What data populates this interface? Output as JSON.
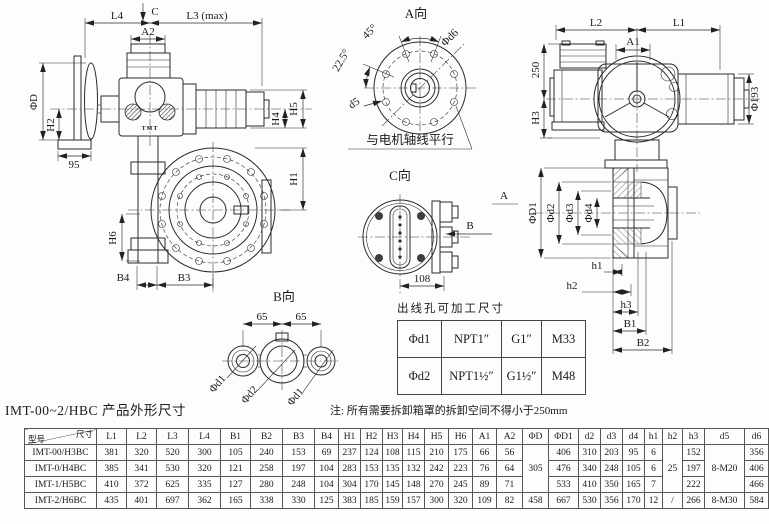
{
  "title": "IMT-00~2/HBC 产品外形尺寸",
  "note": "注: 所有需要拆卸箱罩的拆卸空间不得小于250mm",
  "colors": {
    "line": "#2b2b2b",
    "bg": "#fdfdfc"
  },
  "side_view": {
    "l4": "L4",
    "c": "C",
    "l3": "L3 (max)",
    "a2": "A2",
    "phid": "ΦD",
    "h2": "H2",
    "n95": "95",
    "h5": "H5",
    "h4": "H4",
    "h1": "H1",
    "h6": "H6",
    "b4": "B4",
    "b3": "B3",
    "logo": "TMT"
  },
  "view_a": {
    "label": "A向",
    "a45": "45°",
    "a225": "22.5°",
    "phid6": "Φd6",
    "d5": "d5",
    "note": "与电机轴线平行"
  },
  "front_view": {
    "l2": "L2",
    "l1": "L1",
    "a1": "A1",
    "n250": "250",
    "h3": "H3",
    "phi193": "Φ193"
  },
  "view_c": {
    "label": "C向",
    "n108": "108",
    "arrow_a": "A",
    "arrow_b": "B"
  },
  "section_view": {
    "phid1": "ΦD1",
    "phid2": "Φd2",
    "phid3": "Φd3",
    "phid4": "Φd4",
    "h1": "h1",
    "h2": "h2",
    "h3": "h3",
    "b1": "B1",
    "b2": "B2"
  },
  "view_b": {
    "label": "B向",
    "n65a": "65",
    "n65b": "65",
    "phid1a": "Φd1",
    "phid2": "Φd2",
    "phid1b": "Φd1"
  },
  "outlet_table": {
    "title": "出线孔可加工尺寸",
    "rows": [
      [
        "Φd1",
        "NPT1″",
        "G1″",
        "M33"
      ],
      [
        "Φd2",
        "NPT1½″",
        "G1½″",
        "M48"
      ]
    ]
  },
  "dim_table": {
    "corner_top": "尺寸",
    "corner_bottom": "型号",
    "columns": [
      "L1",
      "L2",
      "L3",
      "L4",
      "B1",
      "B2",
      "B3",
      "B4",
      "H1",
      "H2",
      "H3",
      "H4",
      "H5",
      "H6",
      "A1",
      "A2",
      "ΦD",
      "ΦD1",
      "d2",
      "d3",
      "d4",
      "h1",
      "h2",
      "h3",
      "d5",
      "d6"
    ],
    "rows": [
      {
        "model": "IMT-00/H3BC",
        "cells": [
          "381",
          "320",
          "520",
          "300",
          "105",
          "240",
          "153",
          "69",
          "237",
          "124",
          "108",
          "115",
          "210",
          "175",
          "66",
          "56",
          {
            "v": "305",
            "rowspan": 3
          },
          "406",
          "310",
          "203",
          "95",
          "6",
          {
            "v": "25",
            "rowspan": 3
          },
          "152",
          {
            "v": "8-M20",
            "rowspan": 3
          },
          "356"
        ]
      },
      {
        "model": "IMT-0/H4BC",
        "cells": [
          "385",
          "341",
          "530",
          "320",
          "121",
          "258",
          "197",
          "104",
          "283",
          "153",
          "135",
          "132",
          "242",
          "223",
          "76",
          "64",
          null,
          "476",
          "340",
          "248",
          "105",
          "6",
          null,
          "197",
          null,
          "406"
        ]
      },
      {
        "model": "IMT-1/H5BC",
        "cells": [
          "410",
          "372",
          "625",
          "335",
          "127",
          "280",
          "248",
          "104",
          "304",
          "170",
          "145",
          "148",
          "270",
          "245",
          "89",
          "71",
          null,
          "533",
          "410",
          "350",
          "165",
          "7",
          null,
          "222",
          null,
          "466"
        ]
      },
      {
        "model": "IMT-2/H6BC",
        "cells": [
          "435",
          "401",
          "697",
          "362",
          "165",
          "338",
          "330",
          "125",
          "383",
          "185",
          "159",
          "157",
          "300",
          "320",
          "109",
          "82",
          "458",
          "667",
          "530",
          "356",
          "170",
          "12",
          "/",
          "266",
          "8-M30",
          "584"
        ]
      }
    ]
  }
}
